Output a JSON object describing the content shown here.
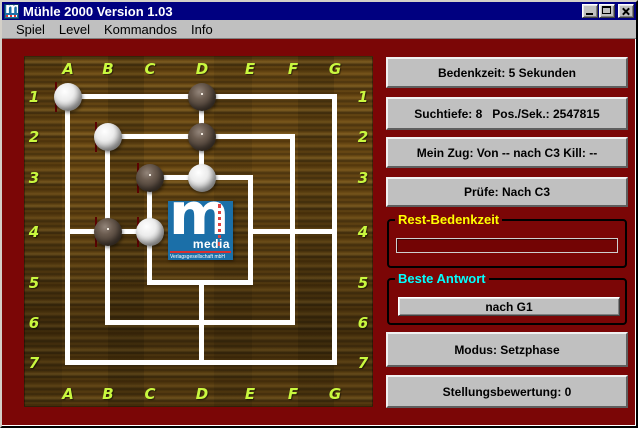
{
  "window": {
    "title": "Mühle 2000 Version 1.03"
  },
  "menu": {
    "items": [
      {
        "label": "Spiel"
      },
      {
        "label": "Level"
      },
      {
        "label": "Kommandos"
      },
      {
        "label": "Info"
      }
    ]
  },
  "board": {
    "column_labels": [
      "A",
      "B",
      "C",
      "D",
      "E",
      "F",
      "G"
    ],
    "row_labels": [
      "1",
      "2",
      "3",
      "4",
      "5",
      "6",
      "7"
    ],
    "stones": [
      {
        "pos": "A1",
        "color": "white",
        "marked": true
      },
      {
        "pos": "D1",
        "color": "dark",
        "marked": false
      },
      {
        "pos": "B2",
        "color": "white",
        "marked": true
      },
      {
        "pos": "D2",
        "color": "dark",
        "marked": false
      },
      {
        "pos": "C3",
        "color": "dark",
        "marked": true
      },
      {
        "pos": "D3",
        "color": "white",
        "marked": false
      },
      {
        "pos": "B4",
        "color": "dark",
        "marked": true
      },
      {
        "pos": "C4",
        "color": "white",
        "marked": true
      }
    ],
    "logo": {
      "letter": "m",
      "name": "media",
      "subtext": "Verlagsgesellschaft mbH"
    }
  },
  "status": {
    "bedenkzeit": "Bedenkzeit: 5 Sekunden",
    "suchtiefe": "Suchtiefe: 8   Pos./Sek.: 2547815",
    "mein_zug": "Mein Zug: Von -- nach C3 Kill: --",
    "pruefe": "Prüfe: Nach C3",
    "rest_bedenkzeit": {
      "label": "Rest-Bedenkzeit",
      "progress_percent": 0
    },
    "beste_antwort": {
      "label": "Beste Antwort",
      "value": "nach G1"
    },
    "modus": "Modus: Setzphase",
    "stellungsbewertung": "Stellungsbewertung: 0"
  },
  "colors": {
    "titlebar": "#000080",
    "client_bg": "#7b0606",
    "panel_bg": "#c0c0c0",
    "board_label": "#c9f83f",
    "rest_label": "#ffff00",
    "beste_label": "#00ffff",
    "logo_bg": "#1b6fa8"
  }
}
